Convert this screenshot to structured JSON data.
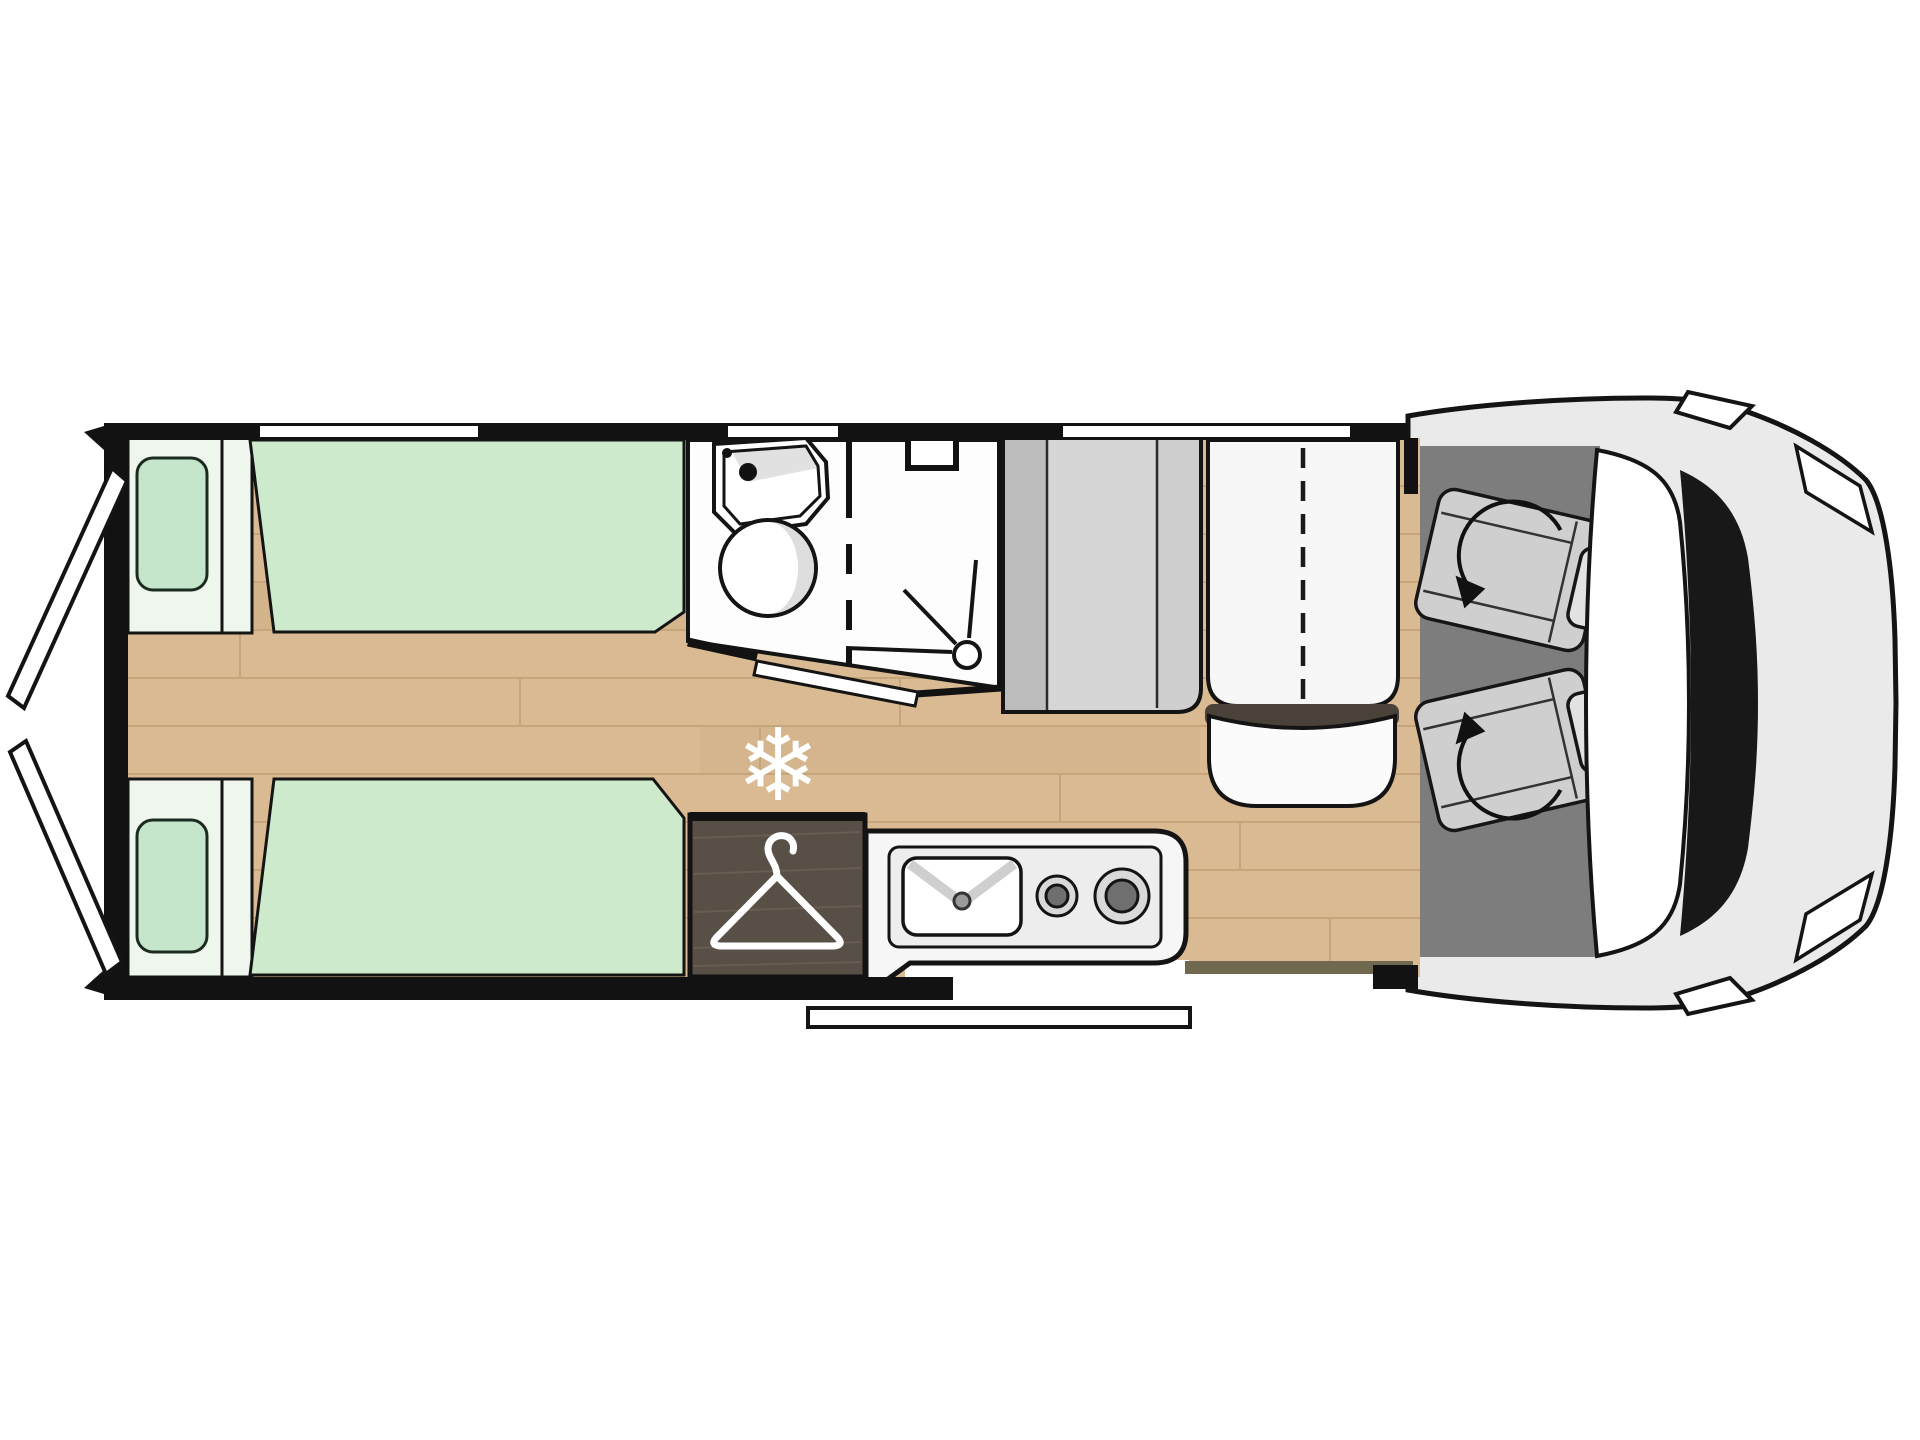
{
  "meta": {
    "kind": "motorhome-floor-plan-top-view",
    "orientation": "cab-front-right, rear-doors-left"
  },
  "icons": {
    "snowflake_char": "❄",
    "hanger": "coat-hanger-icon",
    "swivel_arrow": "rotation-arrow-icon"
  },
  "areas": [
    {
      "name": "rear-twin-bed-top",
      "type": "bed"
    },
    {
      "name": "rear-twin-bed-bottom",
      "type": "bed"
    },
    {
      "name": "rear-doors-open",
      "type": "door"
    },
    {
      "name": "washroom-with-sink-and-toilet",
      "type": "bathroom"
    },
    {
      "name": "shower-cubicle",
      "type": "bathroom"
    },
    {
      "name": "wardrobe-with-hanger",
      "type": "storage"
    },
    {
      "name": "fridge-freezer-snowflake",
      "type": "appliance"
    },
    {
      "name": "kitchen-sink-and-two-burner-hob",
      "type": "kitchen"
    },
    {
      "name": "dinette-travel-bench",
      "type": "seating"
    },
    {
      "name": "cab-swivel-seats",
      "type": "seating"
    },
    {
      "name": "vehicle-cab-front",
      "type": "vehicle"
    },
    {
      "name": "entry-step",
      "type": "access"
    },
    {
      "name": "windows",
      "count": 3
    }
  ],
  "colors": {
    "wall": "#121212",
    "outline": "#141414",
    "bed_green": "#cdeacd",
    "bed_base": "#eff6ee",
    "pillow_green": "#c5e6cb",
    "floor_wood": "#d9ba92",
    "plank_line": "#c2a075",
    "wardrobe_wood": "#584f46",
    "wardrobe_streak": "#6b6154",
    "cab_floor": "#7d7d7d",
    "cabinet_gray": "#cfcfcf",
    "cabinet_strip": "#bcbcbc",
    "cabinet_mid": "#d6d6d6",
    "bench_white": "#f7f7f7",
    "cushion_white": "#fbfbfb",
    "cushion_band": "#4a4238",
    "seat_gray": "#cfcfcf",
    "headrest_gray": "#e2e2e2",
    "body_gray": "#eaeaea",
    "windshield_white": "#ffffff",
    "cowl_dark": "#181818",
    "room_white": "#fdfdfd",
    "counter_white": "#f6f6f6",
    "counter_inner": "#ededed",
    "burner_ring": "#d9d9d9",
    "burner_core": "#6f6f6f",
    "basin_shade": "#dddddd",
    "floor_shadow": "#70684f",
    "icon_white": "#ffffff"
  }
}
